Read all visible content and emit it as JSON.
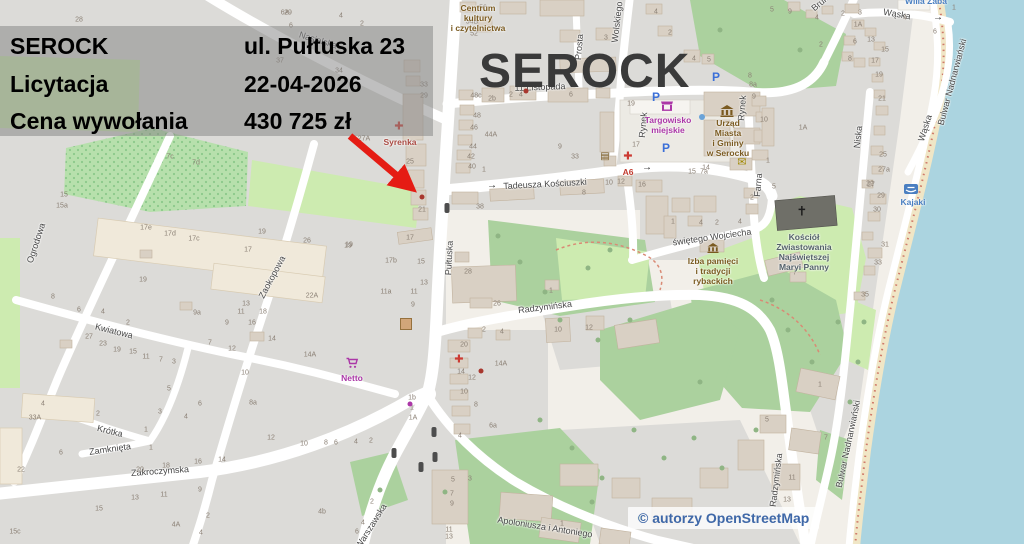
{
  "overlay": {
    "rows": [
      {
        "label": "SEROCK",
        "value": "ul. Pułtuska 23"
      },
      {
        "label": "Licytacja",
        "value": "22-04-2026"
      },
      {
        "label": "Cena wywołania",
        "value": "430 725 zł"
      }
    ]
  },
  "map": {
    "title": "SEROCK",
    "attribution": "© autorzy OpenStreetMap",
    "colors": {
      "water": "#abd4e0",
      "green": "#abd19e",
      "residential": "#dcdbd8",
      "accent_arrow": "#e51c14",
      "poi_brown": "#7a5a20",
      "poi_purple": "#ab37a7",
      "poi_blue": "#4a7fc1",
      "poi_red": "#aa4a42"
    },
    "streets": [
      [
        "Nasielska",
        318,
        40,
        17
      ],
      [
        "Pułtuska",
        449,
        258,
        -87
      ],
      [
        "Wolskiego",
        617,
        22,
        -83
      ],
      [
        "Prosta",
        579,
        47,
        -85
      ],
      [
        "Rynek",
        643,
        125,
        -85
      ],
      [
        "Rynek",
        742,
        108,
        -85
      ],
      [
        "Tadeusza Kościuszki",
        545,
        184,
        -3
      ],
      [
        "świętego Wojciecha",
        712,
        237,
        -8
      ],
      [
        "Farna",
        758,
        185,
        -85
      ],
      [
        "Niska",
        858,
        137,
        -84
      ],
      [
        "Wąska",
        897,
        14,
        10
      ],
      [
        "Wąska",
        925,
        128,
        -72
      ],
      [
        "Bulwar Nadnarwiański",
        952,
        82,
        -75
      ],
      [
        "Bulwar Nadnarwiański",
        848,
        444,
        -78
      ],
      [
        "Radzymińska",
        545,
        307,
        -7
      ],
      [
        "Radzymińska",
        776,
        480,
        -83
      ],
      [
        "Ogrodowa",
        36,
        243,
        -72
      ],
      [
        "Zaokopowa",
        272,
        277,
        -62
      ],
      [
        "Kwiatowa",
        114,
        331,
        14
      ],
      [
        "Krótka",
        110,
        431,
        14
      ],
      [
        "Zamknięta",
        110,
        449,
        -8
      ],
      [
        "Zakroczymska",
        160,
        471,
        -4
      ],
      [
        "Warszawska",
        371,
        526,
        -58
      ],
      [
        "Apoloniusza i Antoniego",
        545,
        527,
        9
      ],
      [
        "Brukowa",
        826,
        -2,
        -40
      ],
      [
        "11 Listopada",
        540,
        87,
        -2
      ]
    ],
    "pois": [
      {
        "name": "centrum-kultury",
        "lines": [
          "Centrum",
          "kultury",
          "i czytelnictwa"
        ],
        "x": 478,
        "y": 3,
        "color": "#7a5a20"
      },
      {
        "name": "syrenka",
        "lines": [
          "Syrenka"
        ],
        "x": 400,
        "y": 137,
        "color": "#aa4a42"
      },
      {
        "name": "netto",
        "lines": [
          "Netto"
        ],
        "x": 352,
        "y": 373,
        "color": "#ab37a7"
      },
      {
        "name": "targowisko-miejskie",
        "lines": [
          "Targowisko",
          "miejskie"
        ],
        "x": 668,
        "y": 115,
        "color": "#ab37a7"
      },
      {
        "name": "urzad-miasta",
        "lines": [
          "Urząd",
          "Miasta",
          "i Gminy",
          "w Serocku"
        ],
        "x": 728,
        "y": 118,
        "color": "#7a5a20"
      },
      {
        "name": "kosciol",
        "lines": [
          "Kościół",
          "Zwiastowania",
          "Najświętszej",
          "Maryi Panny"
        ],
        "x": 804,
        "y": 232,
        "color": "#54616a"
      },
      {
        "name": "izba-pamieci",
        "lines": [
          "Izba pamięci",
          "i tradycji",
          "rybackich"
        ],
        "x": 713,
        "y": 256,
        "color": "#7a5a20"
      },
      {
        "name": "kajaki",
        "lines": [
          "Kajaki"
        ],
        "x": 913,
        "y": 197,
        "color": "#4a7fc1"
      },
      {
        "name": "willa-zaba",
        "lines": [
          "Willa Żaba"
        ],
        "x": 926,
        "y": -4,
        "color": "#4a7fc1"
      },
      {
        "name": "a6-label",
        "lines": [
          "A6"
        ],
        "x": 628,
        "y": 167,
        "color": "#c23b2e"
      }
    ],
    "icons": [
      [
        "pharmacy",
        399,
        127
      ],
      [
        "pharmacy",
        628,
        157
      ],
      [
        "pharmacy",
        459,
        360
      ],
      [
        "parking",
        716,
        77
      ],
      [
        "parking",
        656,
        97
      ],
      [
        "parking",
        666,
        148
      ],
      [
        "book",
        605,
        157
      ],
      [
        "mail",
        742,
        163
      ],
      [
        "cross",
        802,
        211
      ],
      [
        "cart",
        352,
        363
      ],
      [
        "stall",
        667,
        106
      ],
      [
        "townhall",
        727,
        111
      ],
      [
        "museum",
        713,
        248
      ],
      [
        "kayak",
        911,
        189
      ],
      [
        "signal",
        447,
        208
      ],
      [
        "signal",
        434,
        432
      ],
      [
        "signal",
        435,
        457
      ],
      [
        "signal",
        394,
        453
      ],
      [
        "signal",
        421,
        467
      ],
      [
        "arrow",
        492,
        186
      ],
      [
        "arrow",
        647,
        168
      ],
      [
        "arrow",
        938,
        18
      ],
      [
        "workshop",
        406,
        324
      ],
      [
        "dot-red",
        422,
        197
      ],
      [
        "dot-red",
        481,
        371
      ],
      [
        "dot-red",
        526,
        91
      ],
      [
        "dot-purple",
        410,
        404
      ],
      [
        "dot-blue",
        702,
        117
      ]
    ],
    "house_numbers": [
      [
        "28",
        79,
        20
      ],
      [
        "29",
        288,
        13
      ],
      [
        "6A",
        285,
        13
      ],
      [
        "4",
        341,
        16
      ],
      [
        "2",
        362,
        24
      ],
      [
        "6",
        291,
        26
      ],
      [
        "37",
        280,
        61
      ],
      [
        "34",
        339,
        71
      ],
      [
        "33",
        424,
        85
      ],
      [
        "29",
        424,
        96
      ],
      [
        "27A",
        364,
        139
      ],
      [
        "25",
        410,
        162
      ],
      [
        "21",
        422,
        210
      ],
      [
        "17",
        410,
        238
      ],
      [
        "19",
        349,
        245
      ],
      [
        "38",
        480,
        207
      ],
      [
        "7c",
        170,
        157
      ],
      [
        "7d",
        196,
        163
      ],
      [
        "15",
        64,
        195
      ],
      [
        "15a",
        62,
        206
      ],
      [
        "17e",
        146,
        228
      ],
      [
        "17d",
        170,
        234
      ],
      [
        "17c",
        194,
        239
      ],
      [
        "17",
        248,
        250
      ],
      [
        "19",
        143,
        280
      ],
      [
        "8",
        53,
        297
      ],
      [
        "6",
        79,
        310
      ],
      [
        "4",
        103,
        312
      ],
      [
        "2",
        128,
        323
      ],
      [
        "9a",
        197,
        313
      ],
      [
        "9",
        227,
        323
      ],
      [
        "13",
        246,
        304
      ],
      [
        "11",
        241,
        312
      ],
      [
        "27",
        89,
        337
      ],
      [
        "23",
        103,
        344
      ],
      [
        "19",
        117,
        350
      ],
      [
        "15",
        133,
        352
      ],
      [
        "11",
        146,
        357
      ],
      [
        "7",
        161,
        360
      ],
      [
        "3",
        174,
        362
      ],
      [
        "7",
        210,
        343
      ],
      [
        "12",
        232,
        349
      ],
      [
        "10",
        245,
        373
      ],
      [
        "18",
        263,
        312
      ],
      [
        "16",
        252,
        323
      ],
      [
        "14",
        272,
        339
      ],
      [
        "19",
        262,
        232
      ],
      [
        "26",
        307,
        241
      ],
      [
        "19",
        348,
        246
      ],
      [
        "17b",
        391,
        261
      ],
      [
        "15",
        421,
        262
      ],
      [
        "13",
        424,
        283
      ],
      [
        "22A",
        312,
        296
      ],
      [
        "11a",
        386,
        292
      ],
      [
        "11",
        414,
        292
      ],
      [
        "9",
        413,
        305
      ],
      [
        "14A",
        310,
        355
      ],
      [
        "8a",
        253,
        403
      ],
      [
        "1b",
        412,
        398
      ],
      [
        "1",
        412,
        408
      ],
      [
        "1A",
        413,
        418
      ],
      [
        "12",
        271,
        438
      ],
      [
        "10",
        304,
        444
      ],
      [
        "8",
        326,
        443
      ],
      [
        "6",
        336,
        443
      ],
      [
        "4",
        356,
        442
      ],
      [
        "2",
        371,
        441
      ],
      [
        "4",
        43,
        404
      ],
      [
        "33A",
        35,
        418
      ],
      [
        "2",
        98,
        414
      ],
      [
        "5",
        169,
        389
      ],
      [
        "3",
        160,
        412
      ],
      [
        "6",
        200,
        404
      ],
      [
        "4",
        186,
        417
      ],
      [
        "1",
        146,
        430
      ],
      [
        "1",
        151,
        448
      ],
      [
        "6",
        61,
        453
      ],
      [
        "22",
        21,
        470
      ],
      [
        "20",
        140,
        470
      ],
      [
        "18",
        166,
        466
      ],
      [
        "16",
        198,
        462
      ],
      [
        "14",
        222,
        460
      ],
      [
        "13",
        135,
        498
      ],
      [
        "11",
        164,
        495
      ],
      [
        "9",
        200,
        490
      ],
      [
        "15",
        99,
        509
      ],
      [
        "15c",
        15,
        532
      ],
      [
        "4A",
        176,
        525
      ],
      [
        "4",
        201,
        533
      ],
      [
        "2",
        208,
        516
      ],
      [
        "20",
        464,
        345
      ],
      [
        "14",
        461,
        372
      ],
      [
        "12",
        472,
        378
      ],
      [
        "10",
        464,
        392
      ],
      [
        "8",
        476,
        405
      ],
      [
        "6a",
        493,
        426
      ],
      [
        "4",
        460,
        436
      ],
      [
        "14A",
        501,
        364
      ],
      [
        "5",
        453,
        480
      ],
      [
        "3",
        470,
        479
      ],
      [
        "7",
        452,
        494
      ],
      [
        "9",
        452,
        504
      ],
      [
        "11",
        449,
        530
      ],
      [
        "13",
        449,
        537
      ],
      [
        "1",
        562,
        524
      ],
      [
        "4b",
        322,
        512
      ],
      [
        "2",
        372,
        502
      ],
      [
        "4",
        363,
        523
      ],
      [
        "6",
        357,
        532
      ],
      [
        "56",
        483,
        8
      ],
      [
        "54B",
        472,
        22
      ],
      [
        "52",
        474,
        34
      ],
      [
        "4",
        656,
        12
      ],
      [
        "2",
        670,
        33
      ],
      [
        "3",
        606,
        38
      ],
      [
        "4",
        694,
        59
      ],
      [
        "5",
        709,
        60
      ],
      [
        "48c",
        476,
        96
      ],
      [
        "2b",
        492,
        99
      ],
      [
        "2",
        511,
        95
      ],
      [
        "4",
        521,
        95
      ],
      [
        "6",
        571,
        95
      ],
      [
        "19",
        631,
        104
      ],
      [
        "48",
        477,
        116
      ],
      [
        "46",
        474,
        128
      ],
      [
        "44A",
        491,
        135
      ],
      [
        "44",
        473,
        147
      ],
      [
        "42",
        471,
        157
      ],
      [
        "40",
        472,
        167
      ],
      [
        "1",
        484,
        170
      ],
      [
        "17",
        636,
        145
      ],
      [
        "9",
        560,
        147
      ],
      [
        "33",
        575,
        157
      ],
      [
        "10",
        609,
        183
      ],
      [
        "12",
        621,
        182
      ],
      [
        "16",
        642,
        185
      ],
      [
        "8",
        584,
        193
      ],
      [
        "15",
        692,
        172
      ],
      [
        "7a",
        704,
        172
      ],
      [
        "9",
        754,
        97
      ],
      [
        "8",
        750,
        76
      ],
      [
        "8a",
        753,
        85
      ],
      [
        "10",
        764,
        120
      ],
      [
        "1A",
        803,
        128
      ],
      [
        "1",
        768,
        161
      ],
      [
        "5",
        774,
        187
      ],
      [
        "14",
        706,
        168
      ],
      [
        "1",
        673,
        222
      ],
      [
        "4",
        701,
        223
      ],
      [
        "2",
        717,
        223
      ],
      [
        "4",
        740,
        222
      ],
      [
        "2",
        752,
        198
      ],
      [
        "7",
        795,
        273
      ],
      [
        "10",
        558,
        330
      ],
      [
        "12",
        589,
        328
      ],
      [
        "26",
        497,
        304
      ],
      [
        "28",
        468,
        272
      ],
      [
        "1",
        551,
        291
      ],
      [
        "2",
        484,
        330
      ],
      [
        "4",
        502,
        332
      ],
      [
        "5",
        772,
        10
      ],
      [
        "9",
        790,
        12
      ],
      [
        "2",
        843,
        14
      ],
      [
        "3",
        860,
        13
      ],
      [
        "4",
        817,
        18
      ],
      [
        "1A",
        858,
        25
      ],
      [
        "4",
        905,
        18
      ],
      [
        "1",
        954,
        8
      ],
      [
        "6",
        935,
        32
      ],
      [
        "2",
        821,
        45
      ],
      [
        "6",
        855,
        42
      ],
      [
        "8",
        850,
        59
      ],
      [
        "13",
        871,
        40
      ],
      [
        "15",
        885,
        50
      ],
      [
        "17",
        875,
        61
      ],
      [
        "19",
        879,
        75
      ],
      [
        "21",
        882,
        99
      ],
      [
        "22",
        870,
        184
      ],
      [
        "25",
        883,
        155
      ],
      [
        "27a",
        884,
        170
      ],
      [
        "27",
        871,
        185
      ],
      [
        "29",
        881,
        196
      ],
      [
        "30",
        877,
        210
      ],
      [
        "31",
        885,
        245
      ],
      [
        "33",
        878,
        263
      ],
      [
        "35",
        865,
        295
      ],
      [
        "1",
        820,
        385
      ],
      [
        "5",
        767,
        420
      ],
      [
        "7",
        826,
        438
      ],
      [
        "11",
        792,
        478
      ],
      [
        "13",
        787,
        500
      ]
    ]
  }
}
